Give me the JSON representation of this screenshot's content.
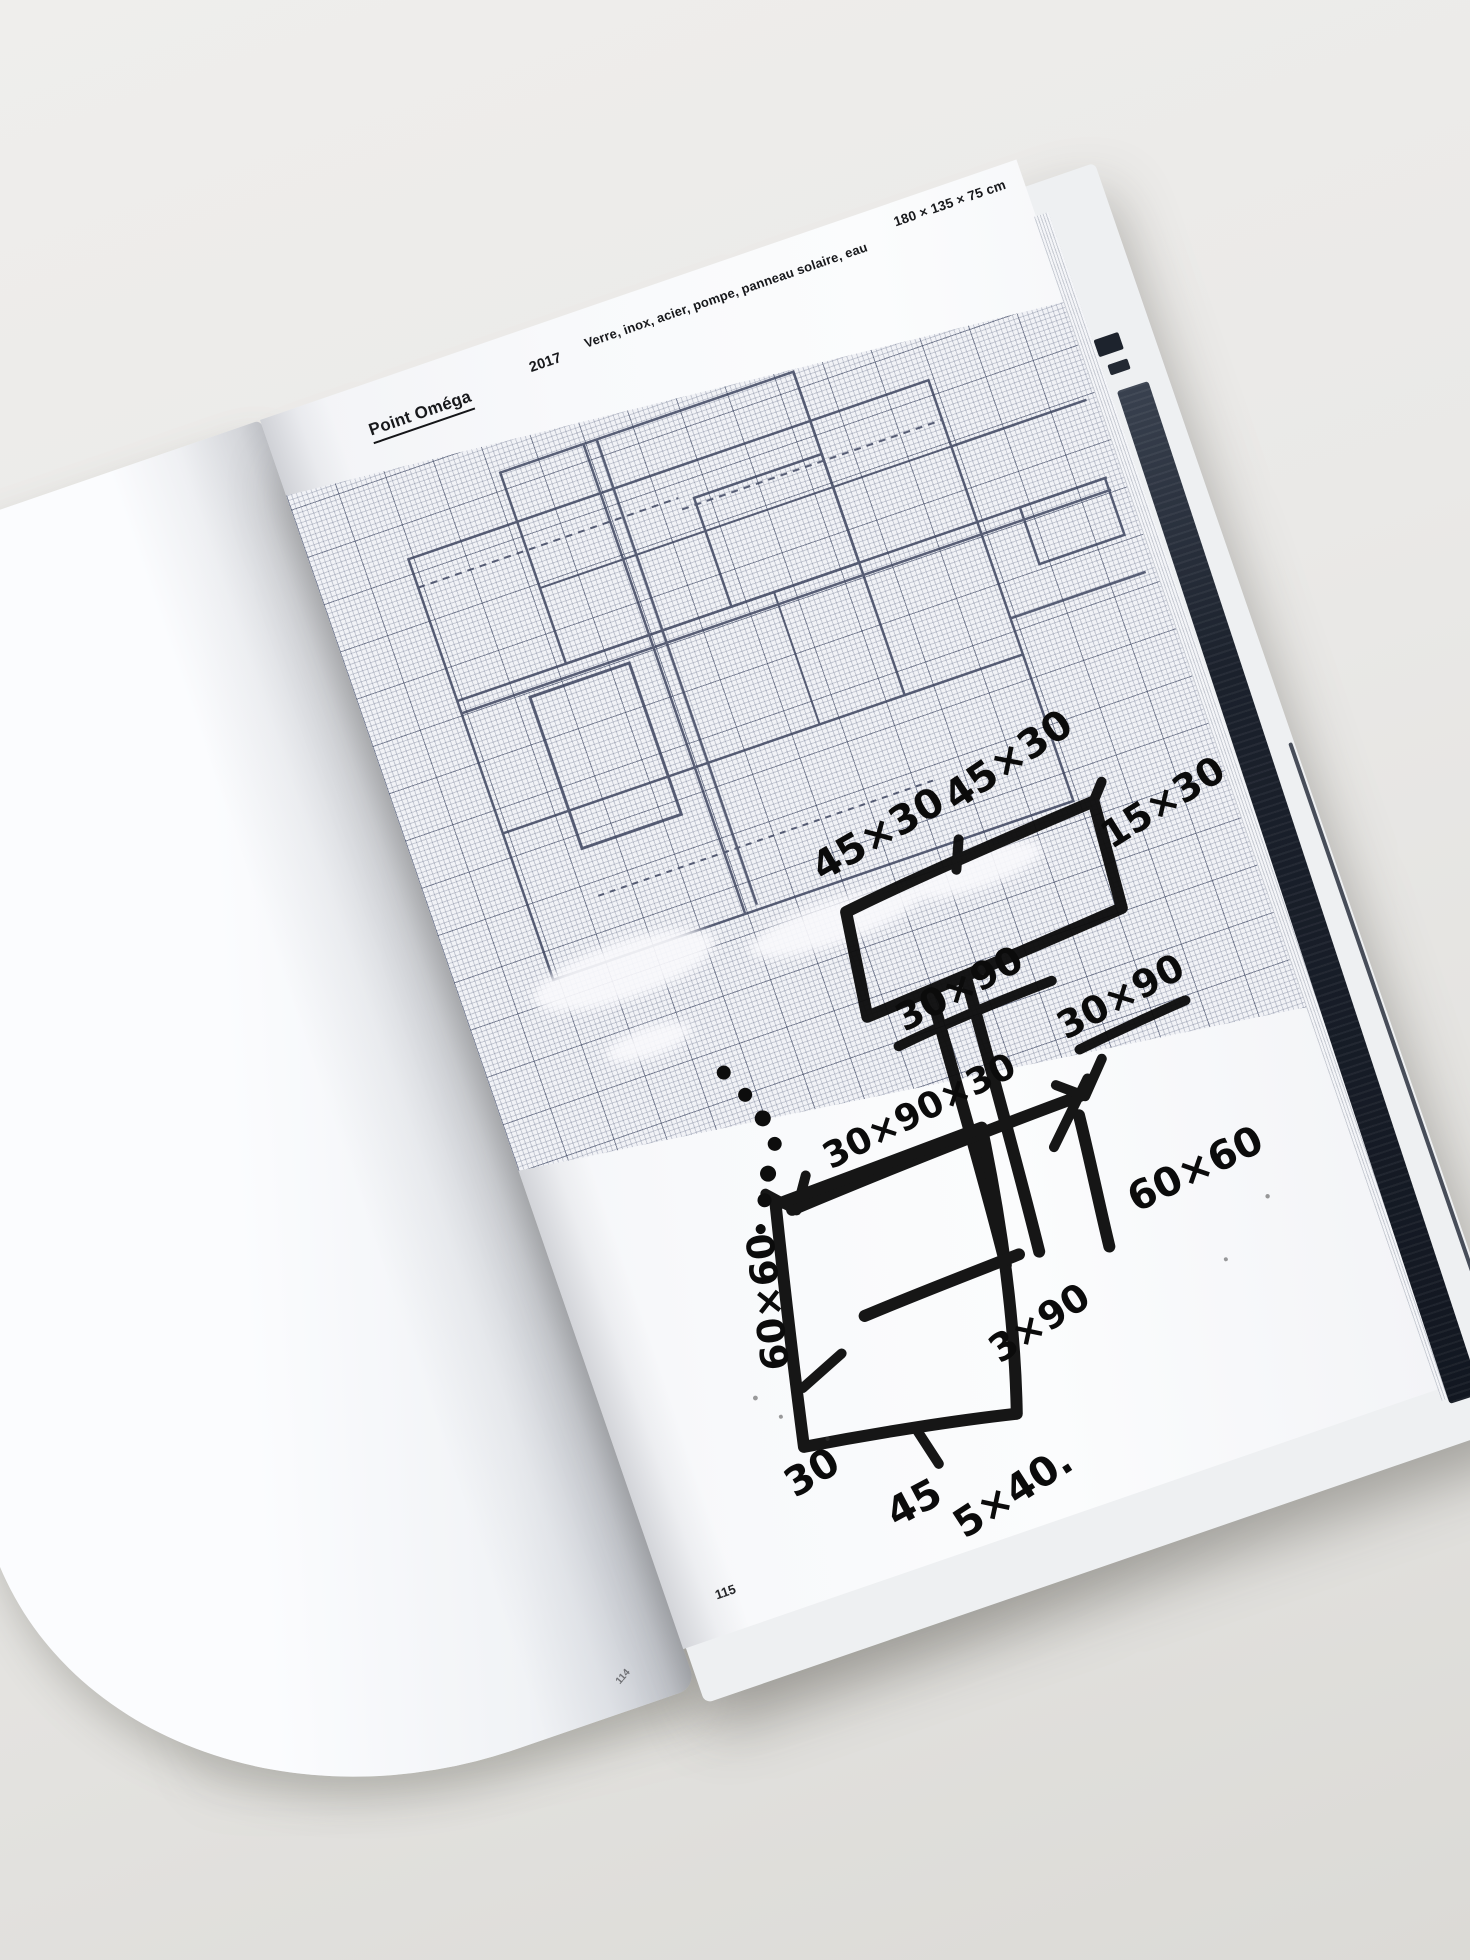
{
  "book": {
    "left_page": {
      "page_number": "114"
    },
    "right_page": {
      "header": {
        "title": "Point Oméga",
        "year": "2017",
        "materials": "Verre, inox, acier, pompe, panneau solaire, eau",
        "dimensions": "180 × 135 × 75 cm"
      },
      "page_number": "115",
      "sketch": {
        "annotations": [
          {
            "id": "top-left",
            "text": "45×30"
          },
          {
            "id": "top-mid",
            "text": "45×30"
          },
          {
            "id": "top-right",
            "text": "15×30"
          },
          {
            "id": "under-box-left",
            "text": "30×90"
          },
          {
            "id": "under-box-right",
            "text": "30×90"
          },
          {
            "id": "column-dim",
            "text": "30×90×30"
          },
          {
            "id": "right-square",
            "text": "60×60"
          },
          {
            "id": "left-vertical",
            "text": "60×60"
          },
          {
            "id": "lower-right",
            "text": "3×90"
          },
          {
            "id": "bottom-left",
            "text": "30"
          },
          {
            "id": "bottom-mid",
            "text": "45"
          },
          {
            "id": "bottom-right",
            "text": "5×40."
          }
        ]
      }
    }
  },
  "colors": {
    "background": "#e9e8e5",
    "page": "#f8f9fb",
    "grid_major": "#39415c",
    "grid_minor": "#8d96ae",
    "marker_ink": "#0d0d0d",
    "fore_edge_dark": "#1b212c"
  }
}
